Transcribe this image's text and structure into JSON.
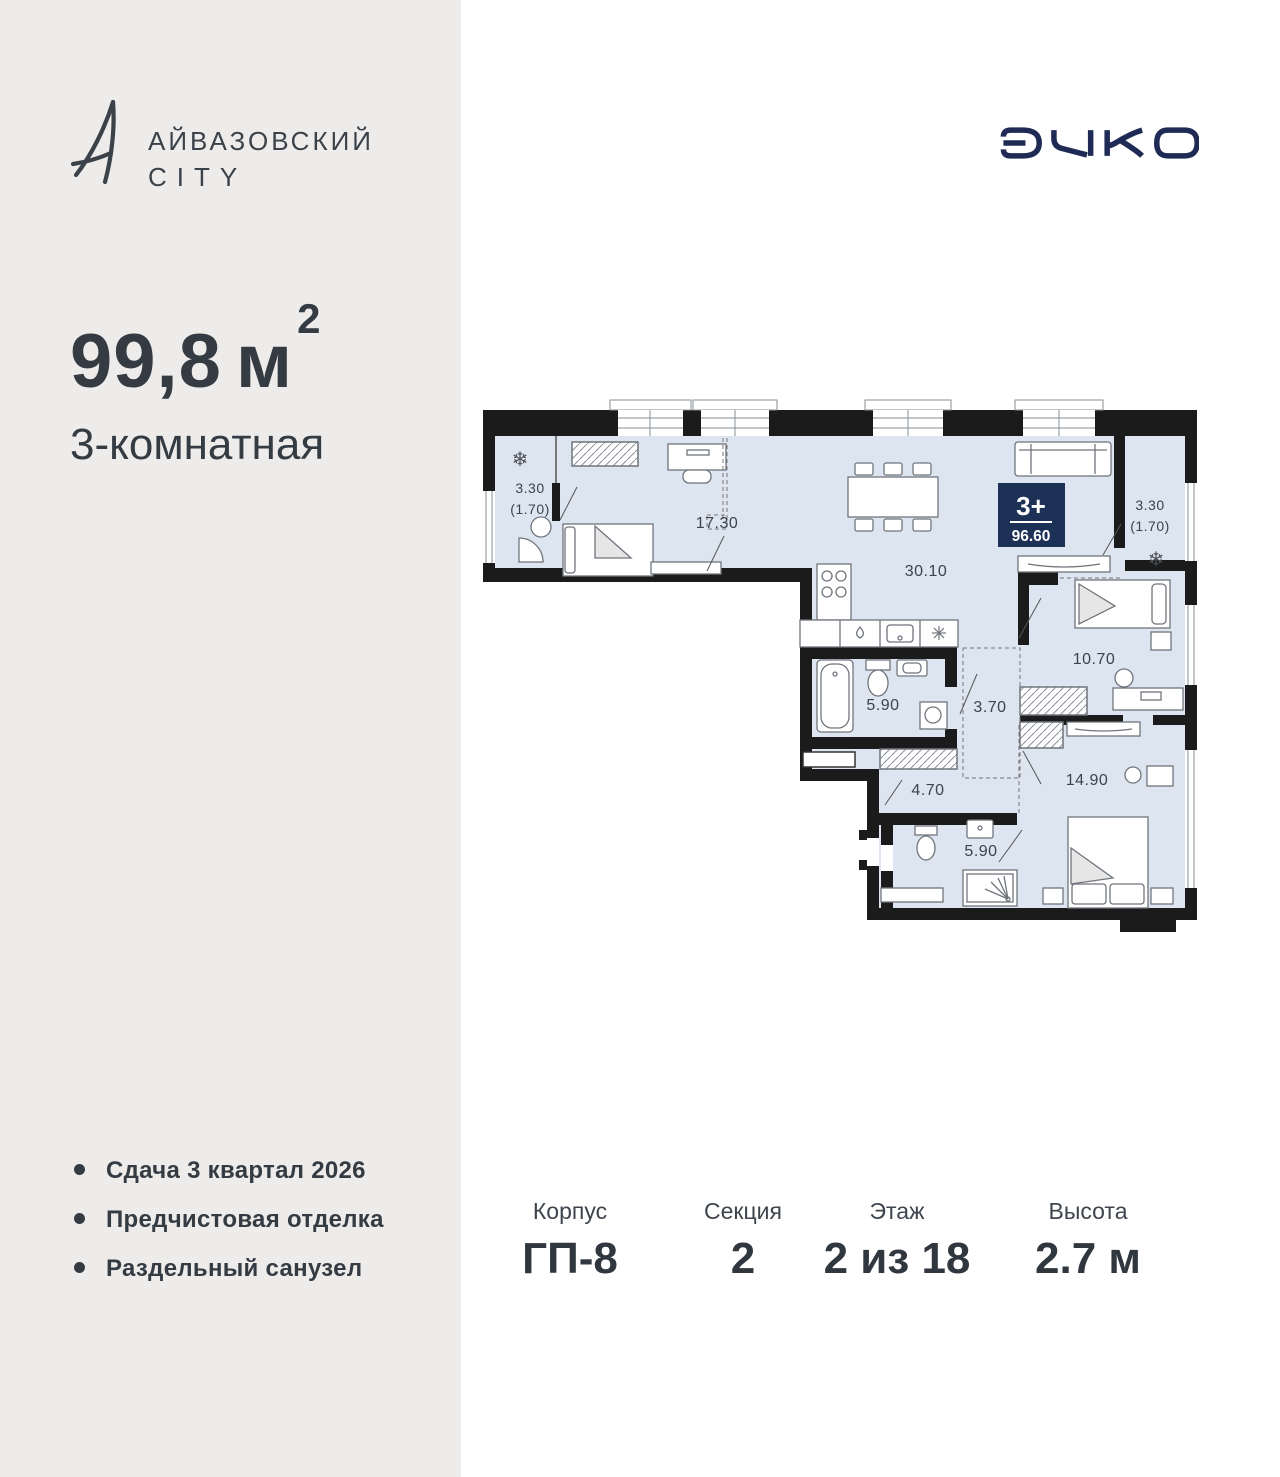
{
  "sidebar": {
    "brand": {
      "line1": "АЙВАЗОВСКИЙ",
      "line2": "CITY"
    },
    "area_value": "99,8",
    "area_unit": "м",
    "area_exp": "2",
    "rooms_label": "3-комнатная",
    "features": [
      "Сдача 3 квартал 2026",
      "Предчистовая отделка",
      "Раздельный санузел"
    ]
  },
  "header": {
    "developer_logo": "ЭНКО"
  },
  "plan": {
    "badge": {
      "rooms": "3+",
      "area": "96.60"
    },
    "labels": {
      "balcony_left_1": "3.30",
      "balcony_left_2": "(1.70)",
      "bedroom1": "17.30",
      "living": "30.10",
      "bath": "5.90",
      "hall": "3.70",
      "bedroom2": "10.70",
      "corridor": "4.70",
      "shower": "5.90",
      "bedroom3": "14.90",
      "balcony_right_1": "3.30",
      "balcony_right_2": "(1.70)"
    },
    "icons": {
      "ac_unit": "❄"
    }
  },
  "info": {
    "columns": [
      {
        "label": "Корпус",
        "value": "ГП-8"
      },
      {
        "label": "Секция",
        "value": "2"
      },
      {
        "label": "Этаж",
        "value": "2 из 18"
      },
      {
        "label": "Высота",
        "value": "2.7 м"
      }
    ]
  },
  "colors": {
    "accent_navy": "#1d3156",
    "logo_navy": "#1f2b55",
    "plan_fill": "#dce5f0",
    "wall": "#1b1b1b",
    "sidebar_bg": "#edecea",
    "text_dark": "#343b43"
  }
}
